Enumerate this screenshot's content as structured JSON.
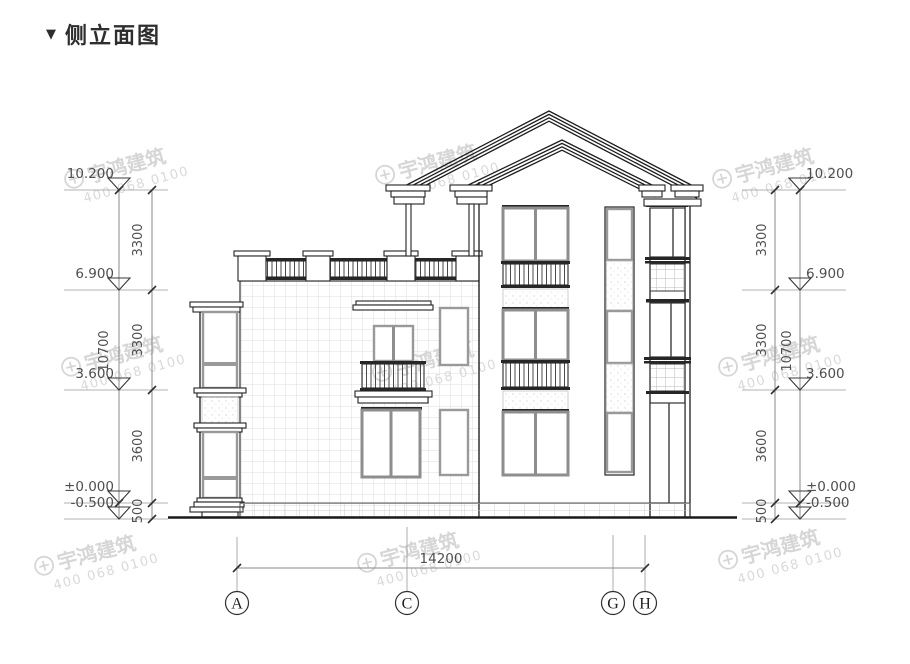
{
  "title": {
    "marker": "▼",
    "text": "侧立面图"
  },
  "watermark": {
    "name": "宇鸿建筑",
    "phone": "400 068 0100"
  },
  "dimensions": {
    "elevation_levels": [
      "10.200",
      "6.900",
      "3.600",
      "±0.000",
      "-0.500"
    ],
    "floor_segments": [
      "3300",
      "3300",
      "3600",
      "500"
    ],
    "total_height": "10700",
    "total_width": "14200"
  },
  "axis_bubbles": [
    "A",
    "C",
    "G",
    "H"
  ]
}
